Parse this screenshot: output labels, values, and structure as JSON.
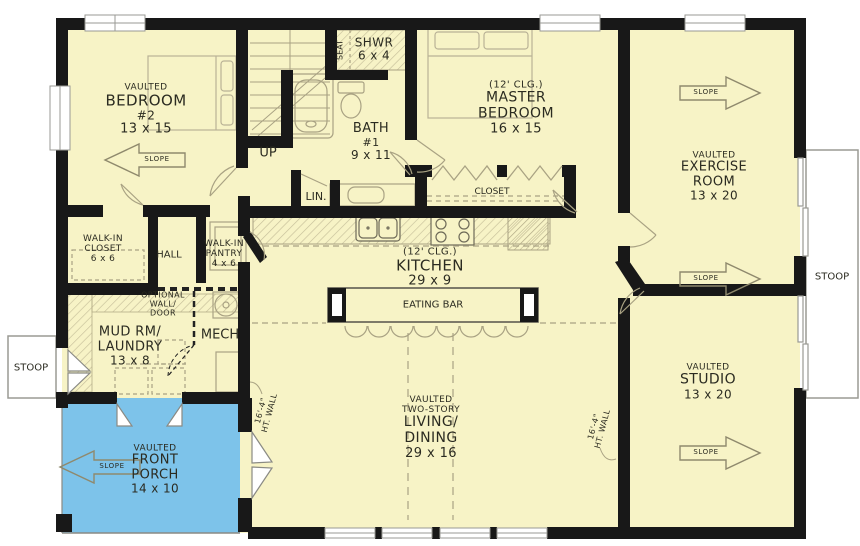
{
  "colors": {
    "floor": "#f7f3c6",
    "porch": "#7dc3ea",
    "wall": "#181818",
    "fixture": "#a9a283",
    "text": "#2b2b21"
  },
  "rooms": {
    "bedroom2": {
      "lines": [
        "VAULTED",
        "BEDROOM",
        "#2",
        "13 x 15"
      ]
    },
    "shower": {
      "lines": [
        "SHWR",
        "6 x 4"
      ],
      "seat": "SEAT"
    },
    "bath1": {
      "lines": [
        "BATH",
        "#1",
        "9 x 11"
      ]
    },
    "master_bedroom": {
      "lines": [
        "(12' CLG.)",
        "MASTER",
        "BEDROOM",
        "16 x 15"
      ]
    },
    "master_closet": {
      "label": "CLOSET"
    },
    "linen": {
      "label": "LIN."
    },
    "stairs": {
      "label": "UP"
    },
    "exercise_room": {
      "lines": [
        "VAULTED",
        "EXERCISE",
        "ROOM",
        "13 x 20"
      ]
    },
    "walk_in_closet": {
      "lines": [
        "WALK-IN",
        "CLOSET",
        "6 x 6"
      ]
    },
    "hall": {
      "label": "HALL"
    },
    "walk_in_pantry": {
      "lines": [
        "WALK-IN",
        "PANTRY",
        "4 x 6"
      ]
    },
    "kitchen": {
      "lines": [
        "(12' CLG.)",
        "KITCHEN",
        "29 x 9"
      ]
    },
    "eating_bar": {
      "label": "EATING BAR"
    },
    "optional_wall": {
      "lines": [
        "OPTIONAL",
        "WALL/",
        "DOOR"
      ]
    },
    "mud_laundry": {
      "lines": [
        "MUD RM/",
        "LAUNDRY",
        "13 x 8"
      ]
    },
    "mech": {
      "label": "MECH"
    },
    "front_porch": {
      "lines": [
        "VAULTED",
        "FRONT",
        "PORCH",
        "14 x 10"
      ]
    },
    "living_dining": {
      "lines": [
        "VAULTED",
        "TWO-STORY",
        "LIVING/",
        "DINING",
        "29 x 16"
      ]
    },
    "studio": {
      "lines": [
        "VAULTED",
        "STUDIO",
        "13 x 20"
      ]
    },
    "stoop_left": {
      "label": "STOOP"
    },
    "stoop_right": {
      "label": "STOOP"
    }
  },
  "annotations": {
    "slope": "SLOPE",
    "wall_height": {
      "lines": [
        "16'-4\"",
        "HT. WALL"
      ]
    }
  }
}
